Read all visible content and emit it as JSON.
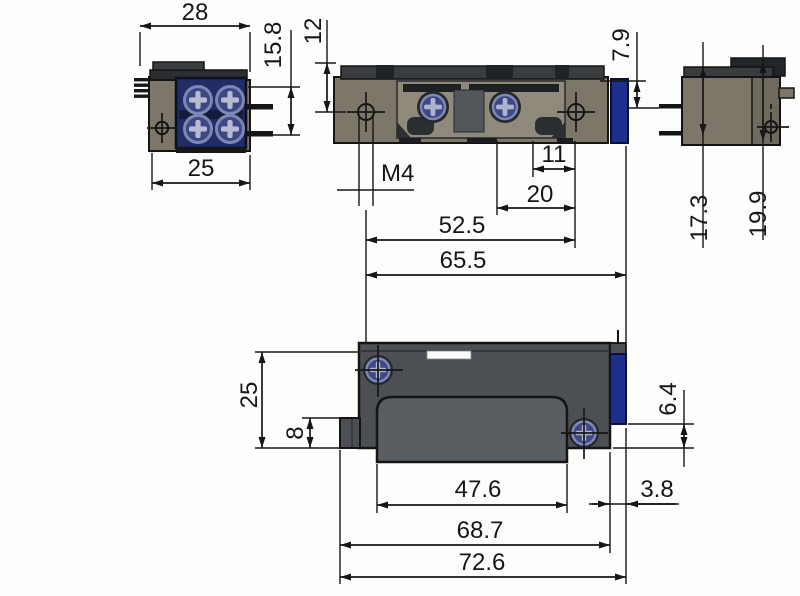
{
  "drawing_type": "dimensioned multi-view technical drawing",
  "views": {
    "connector_front": {
      "label": "connector-front-view",
      "dims": {
        "d28": "28",
        "d15_8": "15.8",
        "d25": "25"
      }
    },
    "top": {
      "label": "top-view",
      "dims": {
        "d12": "12",
        "d7_9": "7.9",
        "m4": "M4",
        "d11": "11",
        "d20": "20",
        "d52_5": "52.5",
        "d65_5": "65.5"
      }
    },
    "side": {
      "label": "side-view",
      "dims": {
        "d17_3": "17.3",
        "d19_9": "19.9"
      }
    },
    "front": {
      "label": "front-view",
      "dims": {
        "d25": "25",
        "d8": "8",
        "d6_4": "6.4",
        "d3_8": "3.8",
        "d47_6": "47.6",
        "d68_7": "68.7",
        "d72_6": "72.6"
      }
    }
  },
  "colors": {
    "line": "#161616",
    "body_olive": "#7c7769",
    "body_dark_gray": "#3a3d40",
    "front_body_slate": "#4c5055",
    "slot_gray": "#585d61",
    "accent_blue": "#1d2e8c",
    "terminal_block_blue": "#222c67",
    "screw_blue": "#3e4884",
    "screw_rim": "#7e87b5",
    "screw_cross": "#aeb3cf"
  }
}
